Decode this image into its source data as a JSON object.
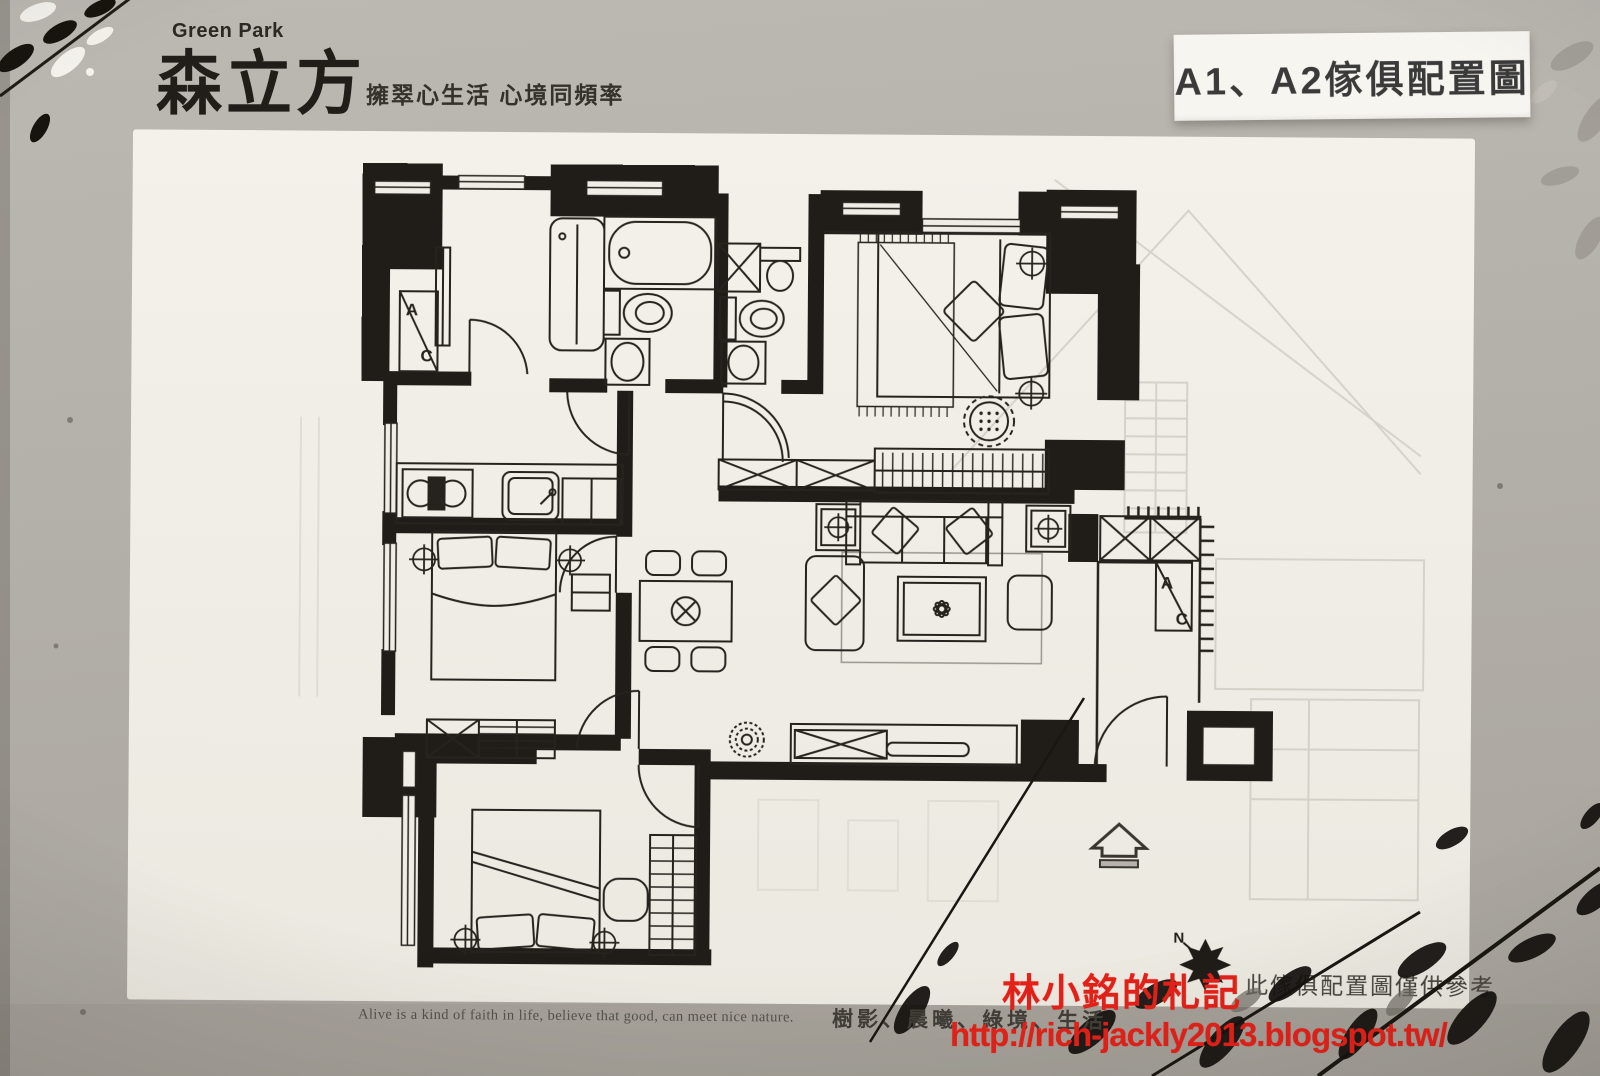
{
  "brand": {
    "en": "Green Park",
    "zh": "森立方",
    "tagline": "擁翠心生活 心境同頻率"
  },
  "badge": {
    "label": "A1、A2傢俱配置圖"
  },
  "plan": {
    "disclaimer": "此傢俱配置圖僅供參考",
    "labels": {
      "a": "A",
      "c": "C",
      "n": "N"
    }
  },
  "watermark": {
    "line1": "林小銘的札記",
    "line2": "http://rich-jackly2013.blogspot.tw/",
    "color": "#e32119"
  },
  "footer": {
    "en": "Alive is a kind of faith in life, believe that good, can meet nice nature.",
    "zh": "樹影、晨曦、綠境、生活"
  },
  "colors": {
    "ink": "#201d18",
    "paper": "#f0ede7",
    "backdrop": "#b3afa9",
    "accent_red": "#e32119"
  }
}
